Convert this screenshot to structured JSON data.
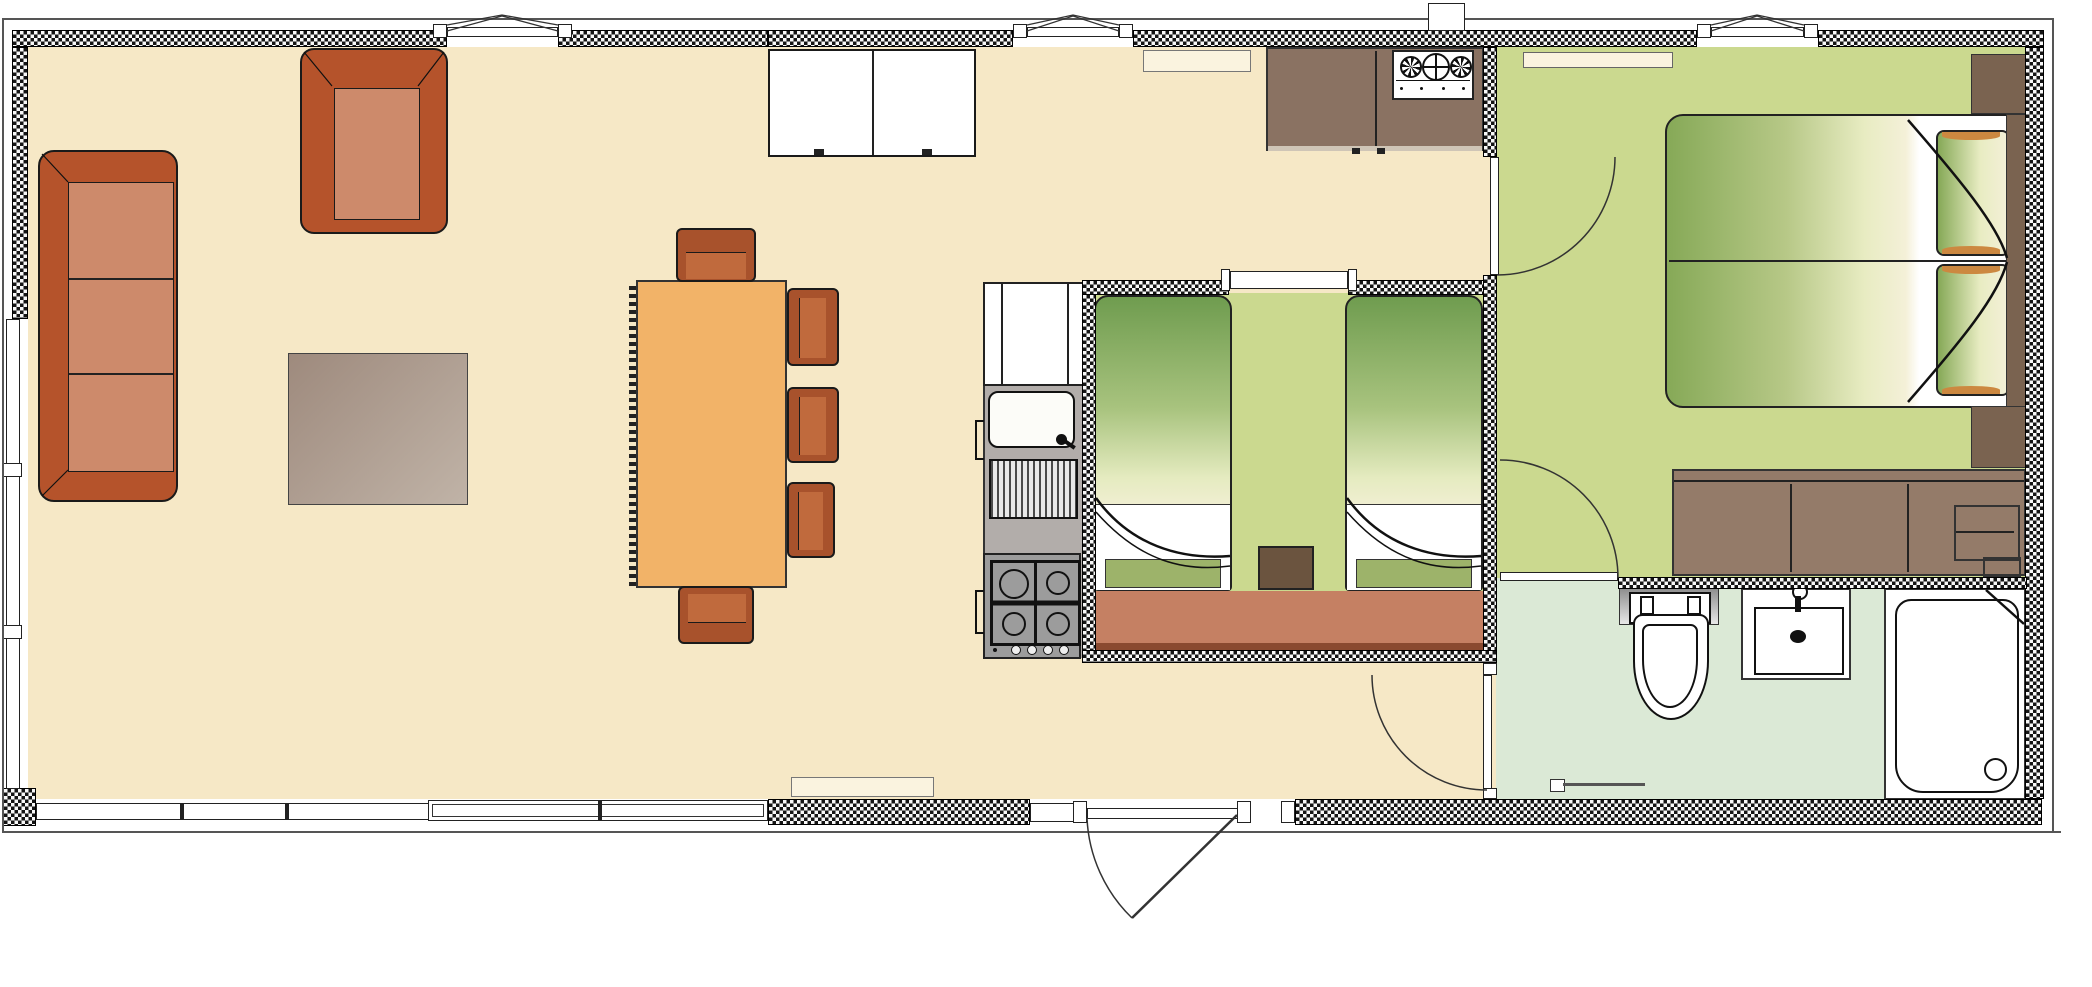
{
  "plan": {
    "type": "floorplan",
    "subject": "single-storey holiday lodge / static caravan",
    "canvas_w": 2092,
    "canvas_h": 987,
    "visible_text": []
  },
  "palette": {
    "wall": "#141414",
    "wall_gap": "#f8f8f8",
    "floor_living": "#f6e8c6",
    "floor_living_deep": "#f2dfb4",
    "floor_bedroom": "#cbd98f",
    "floor_bathroom": "#dbe9d6",
    "upholstery_frame": "#b5532b",
    "upholstery_cushion": "#cd8a6b",
    "dining_table": "#f2b368",
    "dining_chair": "#a8522c",
    "rug_dark": "#9e8a7d",
    "rug_light": "#c0b3a7",
    "kitchen_counter": "#8a7262",
    "counter_edge": "#cfc5b6",
    "appliance_metal": "#9c9c9c",
    "wardrobe": "#c58063",
    "wardrobe_edge": "#8a4a30",
    "dresser": "#947b69",
    "wood_dark": "#7a6350",
    "nightstand": "#6b543f",
    "mattress_green": "#86a957",
    "mattress_pale": "#f4f0d8",
    "pillow_green": "#9db36a",
    "pillow_cap_orange": "#cc8840",
    "fixture_white": "#ffffff",
    "shelf_cream": "#faf3df",
    "line": "#222222"
  },
  "rooms": [
    {
      "id": "living-dining-kitchen",
      "name": "open-plan lounge / diner / kitchen",
      "floor": "floor_living"
    },
    {
      "id": "twin-bedroom",
      "name": "twin bedroom",
      "floor": "floor_bedroom"
    },
    {
      "id": "master-bedroom",
      "name": "double bedroom",
      "floor": "floor_bedroom"
    },
    {
      "id": "bathroom",
      "name": "shower room",
      "floor": "floor_bathroom"
    },
    {
      "id": "hallway",
      "name": "entrance hall",
      "floor": "floor_living"
    }
  ],
  "furniture": {
    "living": [
      "three-seat-sofa",
      "armchair",
      "rug",
      "sideboard",
      "dining-table",
      "dining-chair x5",
      "doormat",
      "wall-shelf"
    ],
    "kitchen": [
      "tall-cabinet",
      "sink",
      "drainer",
      "gas-hob-4-burner",
      "worktop-run",
      "boiler-unit"
    ],
    "twin_bedroom": [
      "single-bed x2",
      "bedside-table",
      "wardrobe-run",
      "window"
    ],
    "master_bedroom": [
      "double-bed",
      "bolster-pillow x2",
      "headboard",
      "nightstand x2",
      "dresser",
      "wall-shelf"
    ],
    "bathroom": [
      "toilet",
      "wash-basin",
      "shower-tray",
      "towel-rail"
    ]
  },
  "doors": [
    {
      "id": "entrance-door",
      "location": "bottom wall of hallway",
      "swing": "outward"
    },
    {
      "id": "master-bedroom-door",
      "location": "partition between kitchen and double bedroom",
      "swing": "into bedroom"
    },
    {
      "id": "bathroom-hall-door",
      "location": "left wall of bathroom",
      "swing": "into hallway"
    },
    {
      "id": "bathroom-master-door",
      "location": "between double bedroom and bathroom",
      "swing": "into bedroom"
    }
  ],
  "windows": [
    {
      "id": "top-window-1",
      "wall": "top"
    },
    {
      "id": "top-window-2",
      "wall": "top"
    },
    {
      "id": "top-window-3",
      "wall": "top"
    },
    {
      "id": "twin-bedroom-window",
      "wall": "top of twin bedroom"
    },
    {
      "id": "left-wall-window",
      "wall": "left"
    },
    {
      "id": "bottom-window-run",
      "wall": "bottom left"
    }
  ]
}
